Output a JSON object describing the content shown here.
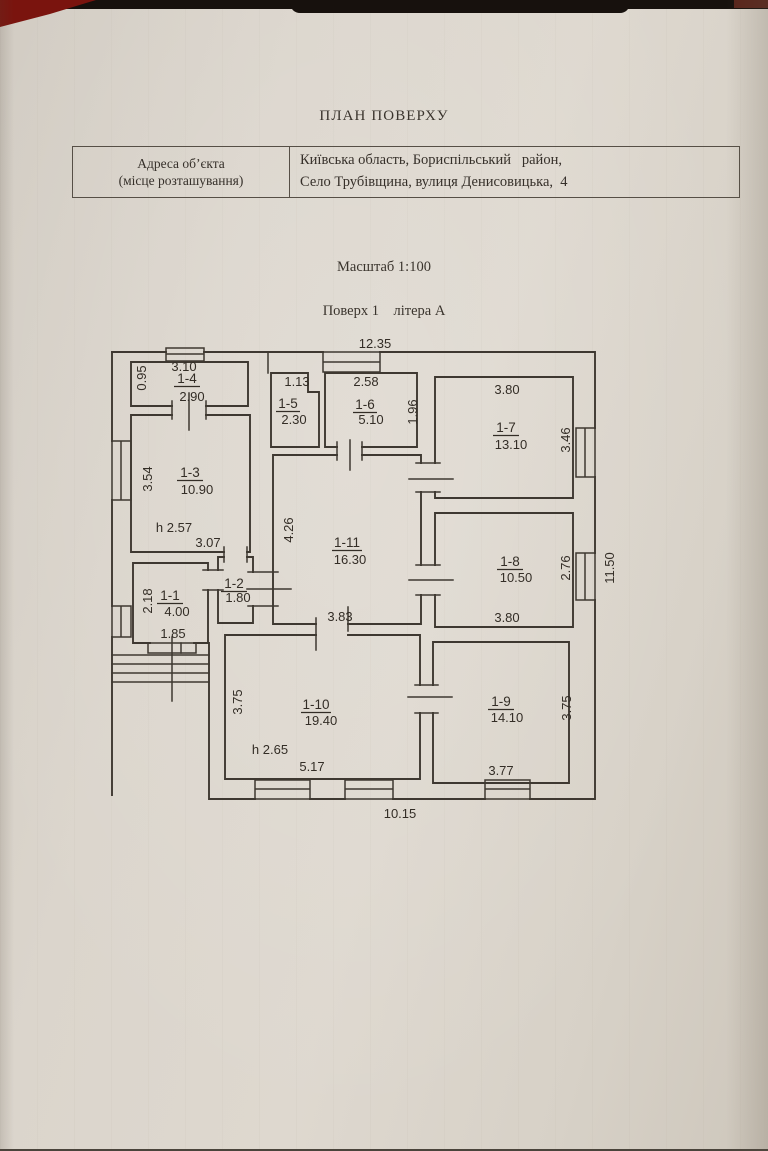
{
  "page": {
    "title": "ПЛАН ПОВЕРХУ",
    "scale_label": "Масштаб 1:100",
    "floor_label": "Поверх 1    літера А",
    "address_table": {
      "label_line1": "Адреса об’єкта",
      "label_line2": "(місце розташування)",
      "value_line1": "Київська область, Бориспільський   район,",
      "value_line2": "Село Трубівщина, вулиця Денисовицька,  4"
    }
  },
  "plan": {
    "overall": {
      "top": "12.35",
      "right": "11.50",
      "bottom": "10.15"
    },
    "rooms": [
      {
        "id": "1-1",
        "area": "4.00",
        "dims": {
          "left": "2.18",
          "bottom": "1.85"
        }
      },
      {
        "id": "1-2",
        "area": "1.80",
        "dims": {}
      },
      {
        "id": "1-3",
        "area": "10.90",
        "dims": {
          "left": "3.54",
          "bottom": "3.07",
          "height": "h 2.57"
        }
      },
      {
        "id": "1-4",
        "area": "2.90",
        "dims": {
          "left": "0.95",
          "top": "3.10"
        }
      },
      {
        "id": "1-5",
        "area": "2.30",
        "dims": {
          "top": "1.13"
        }
      },
      {
        "id": "1-6",
        "area": "5.10",
        "dims": {
          "top": "2.58",
          "right": "1.96"
        }
      },
      {
        "id": "1-7",
        "area": "13.10",
        "dims": {
          "top": "3.80",
          "right": "3.46"
        }
      },
      {
        "id": "1-8",
        "area": "10.50",
        "dims": {
          "right": "2.76",
          "bottom": "3.80"
        }
      },
      {
        "id": "1-9",
        "area": "14.10",
        "dims": {
          "right": "3.75",
          "bottom": "3.77"
        }
      },
      {
        "id": "1-10",
        "area": "19.40",
        "dims": {
          "left": "3.75",
          "bottom": "5.17",
          "height": "h 2.65"
        }
      },
      {
        "id": "1-11",
        "area": "16.30",
        "dims": {
          "left": "4.26",
          "bottom": "3.83"
        }
      }
    ]
  }
}
